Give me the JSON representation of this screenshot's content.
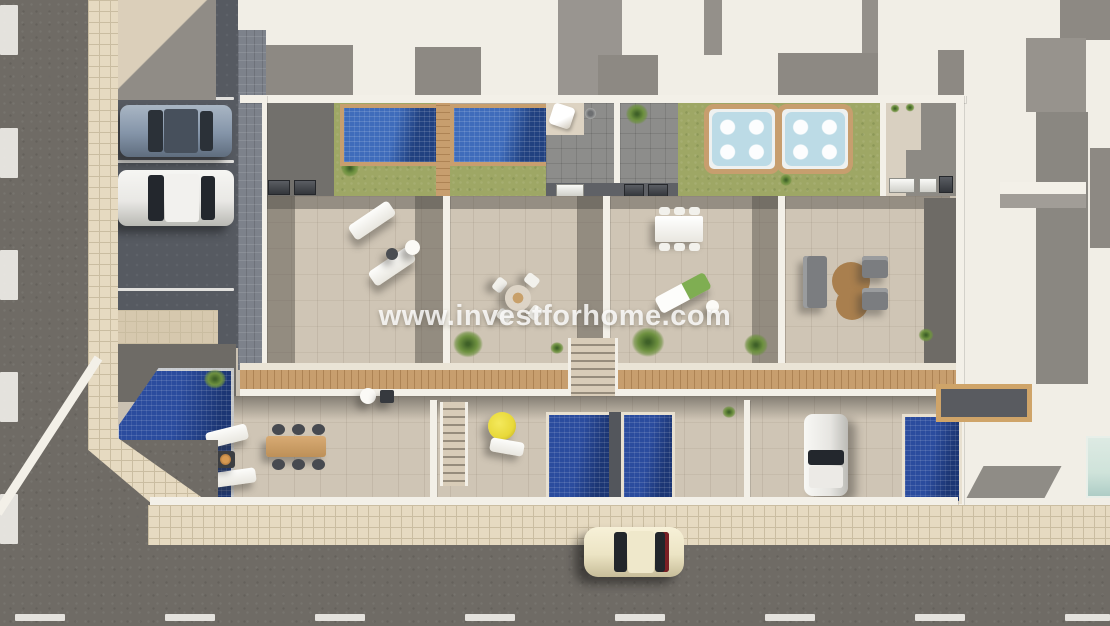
{
  "meta": {
    "title": "Aerial 3D architectural render of a townhouse development",
    "view": "top-down"
  },
  "watermark": {
    "text": "www.investforhome.com"
  },
  "palette": {
    "asphalt": "#6f6b65",
    "parking": "#565a61",
    "sidewalk": "#e6dac1",
    "sidewalk-line": "#cabda1",
    "terrace": "#cfc5b5",
    "wall": "#f3f0e8",
    "roof": "#f1eee6",
    "roof-shadow": "#8d8983",
    "pool-blue": "#3f6cbb",
    "pool-dark": "#214180",
    "pool-navy": "#2b4c9e",
    "lawn": "#9ea765",
    "wood": "#c79e6e",
    "wood-line": "#ad8354",
    "tub-water": "#bcdbe6",
    "umbrella-yellow": "#e8d93a",
    "rug-brown": "#a97f4e",
    "dark-gray": "#6e6b66",
    "equip-strip": "#5f6166",
    "glass-green": "#cfe3da",
    "car-silver": "#8494a8",
    "car-white": "#e9e8e5",
    "car-cream": "#ece4c4"
  },
  "scene": {
    "type": "aerial 3D render, new-build row of 4 townhouses on a corner plot",
    "upper_level": [
      "blue pool with wooden deck and lawn (unit 1)",
      "blue pool with wooden deck and lawn (unit 2)",
      "two gray tiled patios with plants and outdoor shower",
      "lawn with square hot tub on wooden deck (unit 3)",
      "lawn with square hot tub on wooden deck (unit 4)",
      "air-conditioning units along service strip"
    ],
    "roof_terraces": [
      "two sun loungers with round side tables",
      "round dining table with four chairs",
      "rectangular dining table with six chairs and a lounger",
      "lounge set: two sofas, two armchairs, curvy brown rug"
    ],
    "lower_level": [
      "corner pool, wooden dining table with six chairs, two loungers, fire pit",
      "terrace with yellow parasol, lounger and plunge pool",
      "plunge pool terrace with plants and staircase",
      "driveway with parked white car, plunge pool and pergola"
    ],
    "surroundings": [
      "parking bays with silver car and white car under carport",
      "street along bottom with cream car driving",
      "tiled pedestrian sidewalks on left and bottom",
      "white neighboring rooftops on right"
    ]
  }
}
